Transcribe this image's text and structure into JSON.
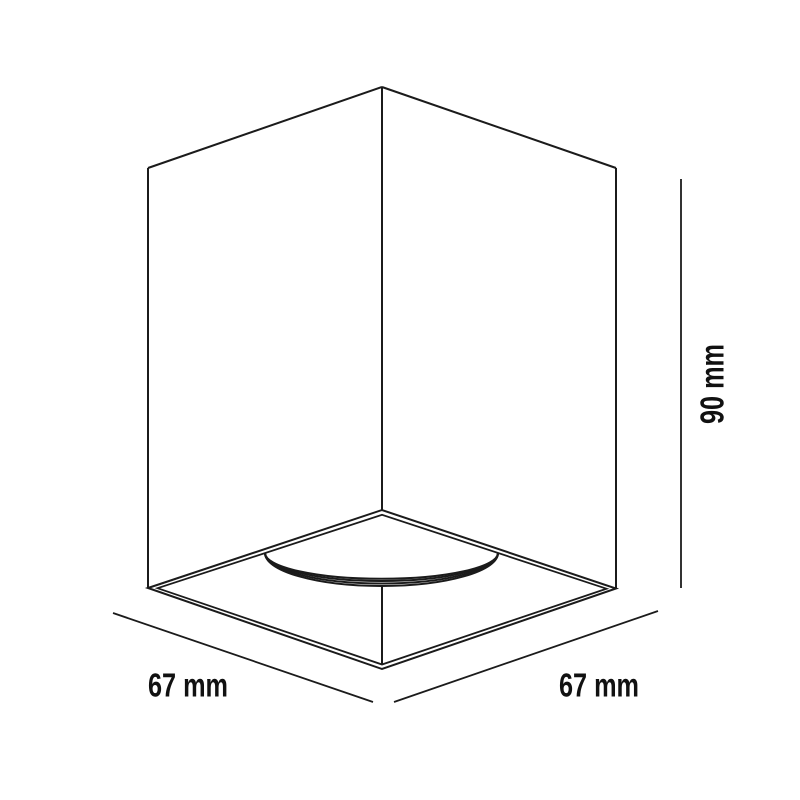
{
  "drawing": {
    "labels": {
      "width_front": "67 mm",
      "width_side": "67 mm",
      "height": "90 mm"
    },
    "dimensions": [
      {
        "edge": "bottom-left",
        "value": 67,
        "unit": "mm",
        "label": "67 mm"
      },
      {
        "edge": "bottom-right",
        "value": 67,
        "unit": "mm",
        "label": "67 mm"
      },
      {
        "edge": "height",
        "value": 90,
        "unit": "mm",
        "label": "90 mm"
      }
    ],
    "colors": {
      "line": "#1b1b1b",
      "text": "#111111",
      "background": "#ffffff"
    }
  }
}
